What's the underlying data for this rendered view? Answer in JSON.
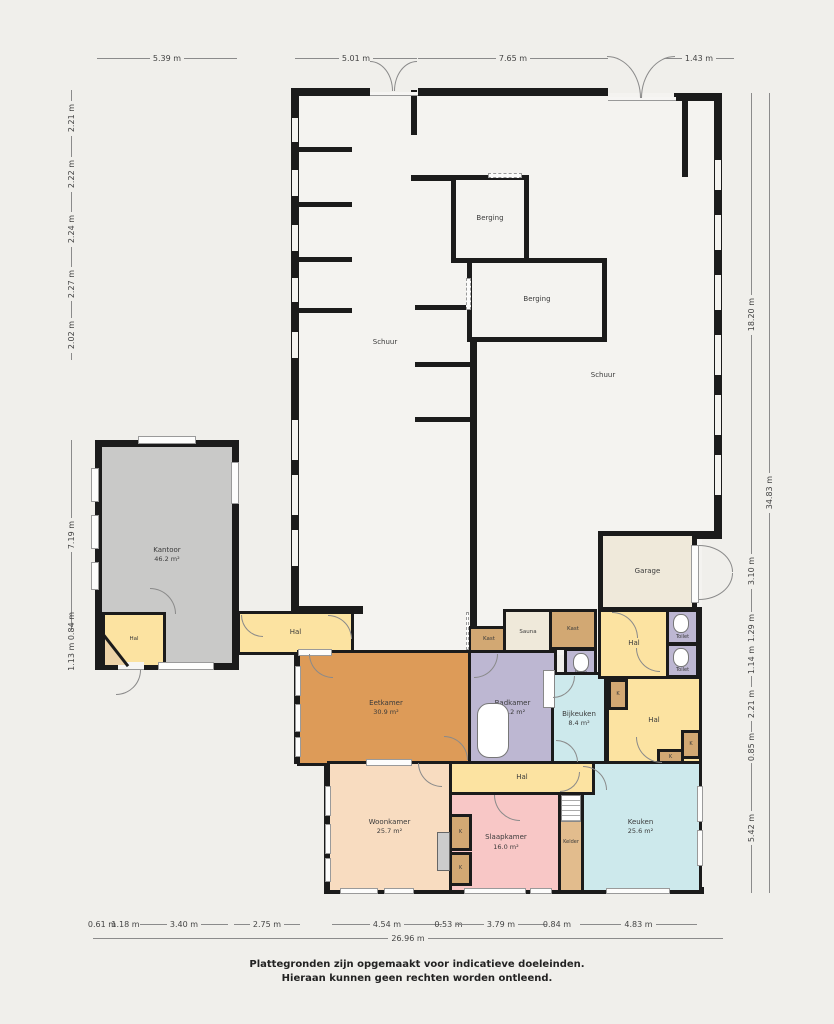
{
  "footer": {
    "line1": "Plattegronden zijn opgemaakt voor indicatieve doeleinden.",
    "line2": "Hieraan kunnen geen rechten worden ontleend."
  },
  "rooms": {
    "schuur_left": {
      "label": "Schuur"
    },
    "schuur_right": {
      "label": "Schuur"
    },
    "berging_top": {
      "label": "Berging"
    },
    "berging_mid": {
      "label": "Berging"
    },
    "garage": {
      "label": "Garage"
    },
    "kantoor": {
      "label": "Kantoor",
      "area": "46.2 m²"
    },
    "hal_kantoor": {
      "label": "Hal"
    },
    "hal_corridor": {
      "label": "Hal"
    },
    "hal_entry": {
      "label": "Hal"
    },
    "hal_center": {
      "label": "Hal"
    },
    "hal_south": {
      "label": "Hal"
    },
    "kast_west": {
      "label": "Kast"
    },
    "kast_east": {
      "label": "Kast"
    },
    "sauna": {
      "label": "Sauna"
    },
    "toilet_a": {
      "label": "Toilet"
    },
    "toilet_b": {
      "label": "Toilet"
    },
    "toilet_c": {
      "label": "Toilet"
    },
    "eetkamer": {
      "label": "Eetkamer",
      "area": "30.9 m²"
    },
    "badkamer": {
      "label": "Badkamer",
      "area": "11.2 m²"
    },
    "bijkeuken": {
      "label": "Bijkeuken",
      "area": "8.4 m²"
    },
    "woonkamer": {
      "label": "Woonkamer",
      "area": "25.7 m²"
    },
    "slaapkamer": {
      "label": "Slaapkamer",
      "area": "16.0 m²"
    },
    "kelder": {
      "label": "Kelder"
    },
    "keuken": {
      "label": "Keuken",
      "area": "25.6 m²"
    },
    "closet": {
      "label": "K"
    }
  },
  "dimensions": {
    "top": [
      "5.39 m",
      "5.01 m",
      "7.65 m",
      "1.43 m"
    ],
    "left_upper": [
      "2.21 m",
      "2.22 m",
      "2.24 m",
      "2.27 m",
      "2.02 m"
    ],
    "left_lower": [
      "7.19 m",
      "1.13 m 0.84 m"
    ],
    "right_long": [
      "18.20 m",
      "34.83 m"
    ],
    "right_lower": [
      "3.10 m",
      "1.29 m",
      "1.14 m",
      "2.21 m",
      "0.85 m",
      "5.42 m"
    ],
    "bottom": [
      "0.61 m",
      "1.18 m",
      "3.40 m",
      "2.75 m",
      "4.54 m",
      "0.53 m",
      "3.79 m",
      "0.84 m",
      "4.83 m"
    ],
    "bottom_total": "26.96 m"
  },
  "palette": {
    "background": "#f0efeb",
    "wall": "#1b1b1b",
    "hal": "#fce3a1",
    "kast": "#d2a873",
    "sanitary": "#bdb7d2",
    "eetkamer": "#dd9b58",
    "keuken": "#cde9ec",
    "woonkamer": "#f8dcc0",
    "slaapkamer": "#f8c7c6",
    "kelder": "#e2bc8d",
    "kantoor": "#c9c9c8",
    "garage": "#efe9da",
    "schuur": "#f4f3f0"
  }
}
